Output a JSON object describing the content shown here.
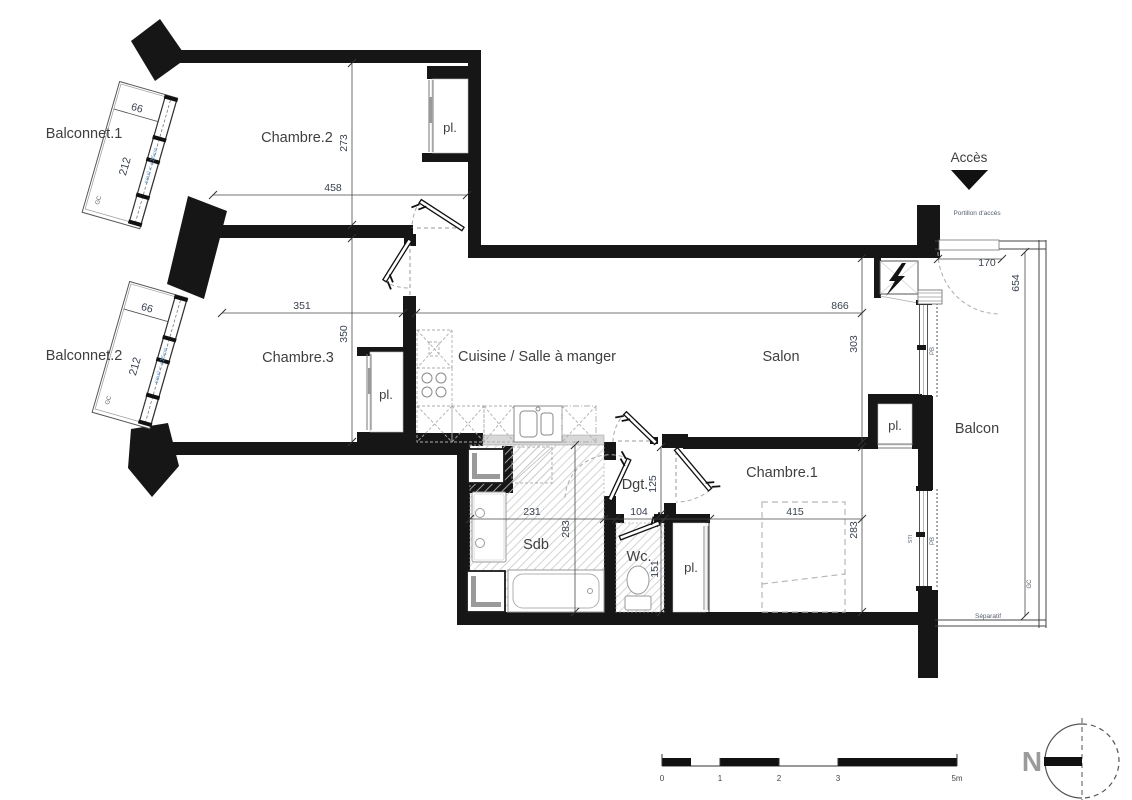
{
  "colors": {
    "wall": "#161616",
    "hatch": "#c9c9c9",
    "label_text": "#3f3f3f",
    "dim_text": "#39414f",
    "tiny_text": "#55606e",
    "seuil_blue": "#6fa3d9",
    "north_grey": "#9b9b9b"
  },
  "labels": {
    "balconnet1": "Balconnet.1",
    "balconnet2": "Balconnet.2",
    "chambre2": "Chambre.2",
    "chambre3": "Chambre.3",
    "cuisine": "Cuisine / Salle à manger",
    "salon": "Salon",
    "balcon": "Balcon",
    "sdb": "Sdb",
    "wc": "Wc.",
    "dgt": "Dgt.",
    "chambre1": "Chambre.1",
    "closet": "pl.",
    "acces": "Accès",
    "portillon": "Portillon d'accès",
    "separatif": "Séparatif",
    "north": "N"
  },
  "dims": {
    "chambre2": {
      "w": "458",
      "h": "273"
    },
    "chambre3": {
      "w": "351",
      "h": "350"
    },
    "salon": {
      "w": "866",
      "h": "303"
    },
    "chambre1": {
      "w": "415",
      "h": "283"
    },
    "sdb": {
      "w": "231",
      "h": "283"
    },
    "wc": {
      "w": "104",
      "h": "151"
    },
    "dgt": {
      "h": "125"
    },
    "balconnet": {
      "w": "66",
      "l": "212"
    },
    "gate": "170",
    "balcon_l": "654"
  },
  "tags": {
    "gc": "GC",
    "pb": "PB",
    "sti": "STI",
    "seuil": "seuil < ±15cm"
  },
  "scalebar": {
    "t0": "0",
    "t1": "1",
    "t2": "2",
    "t3": "3",
    "t5": "5m"
  }
}
